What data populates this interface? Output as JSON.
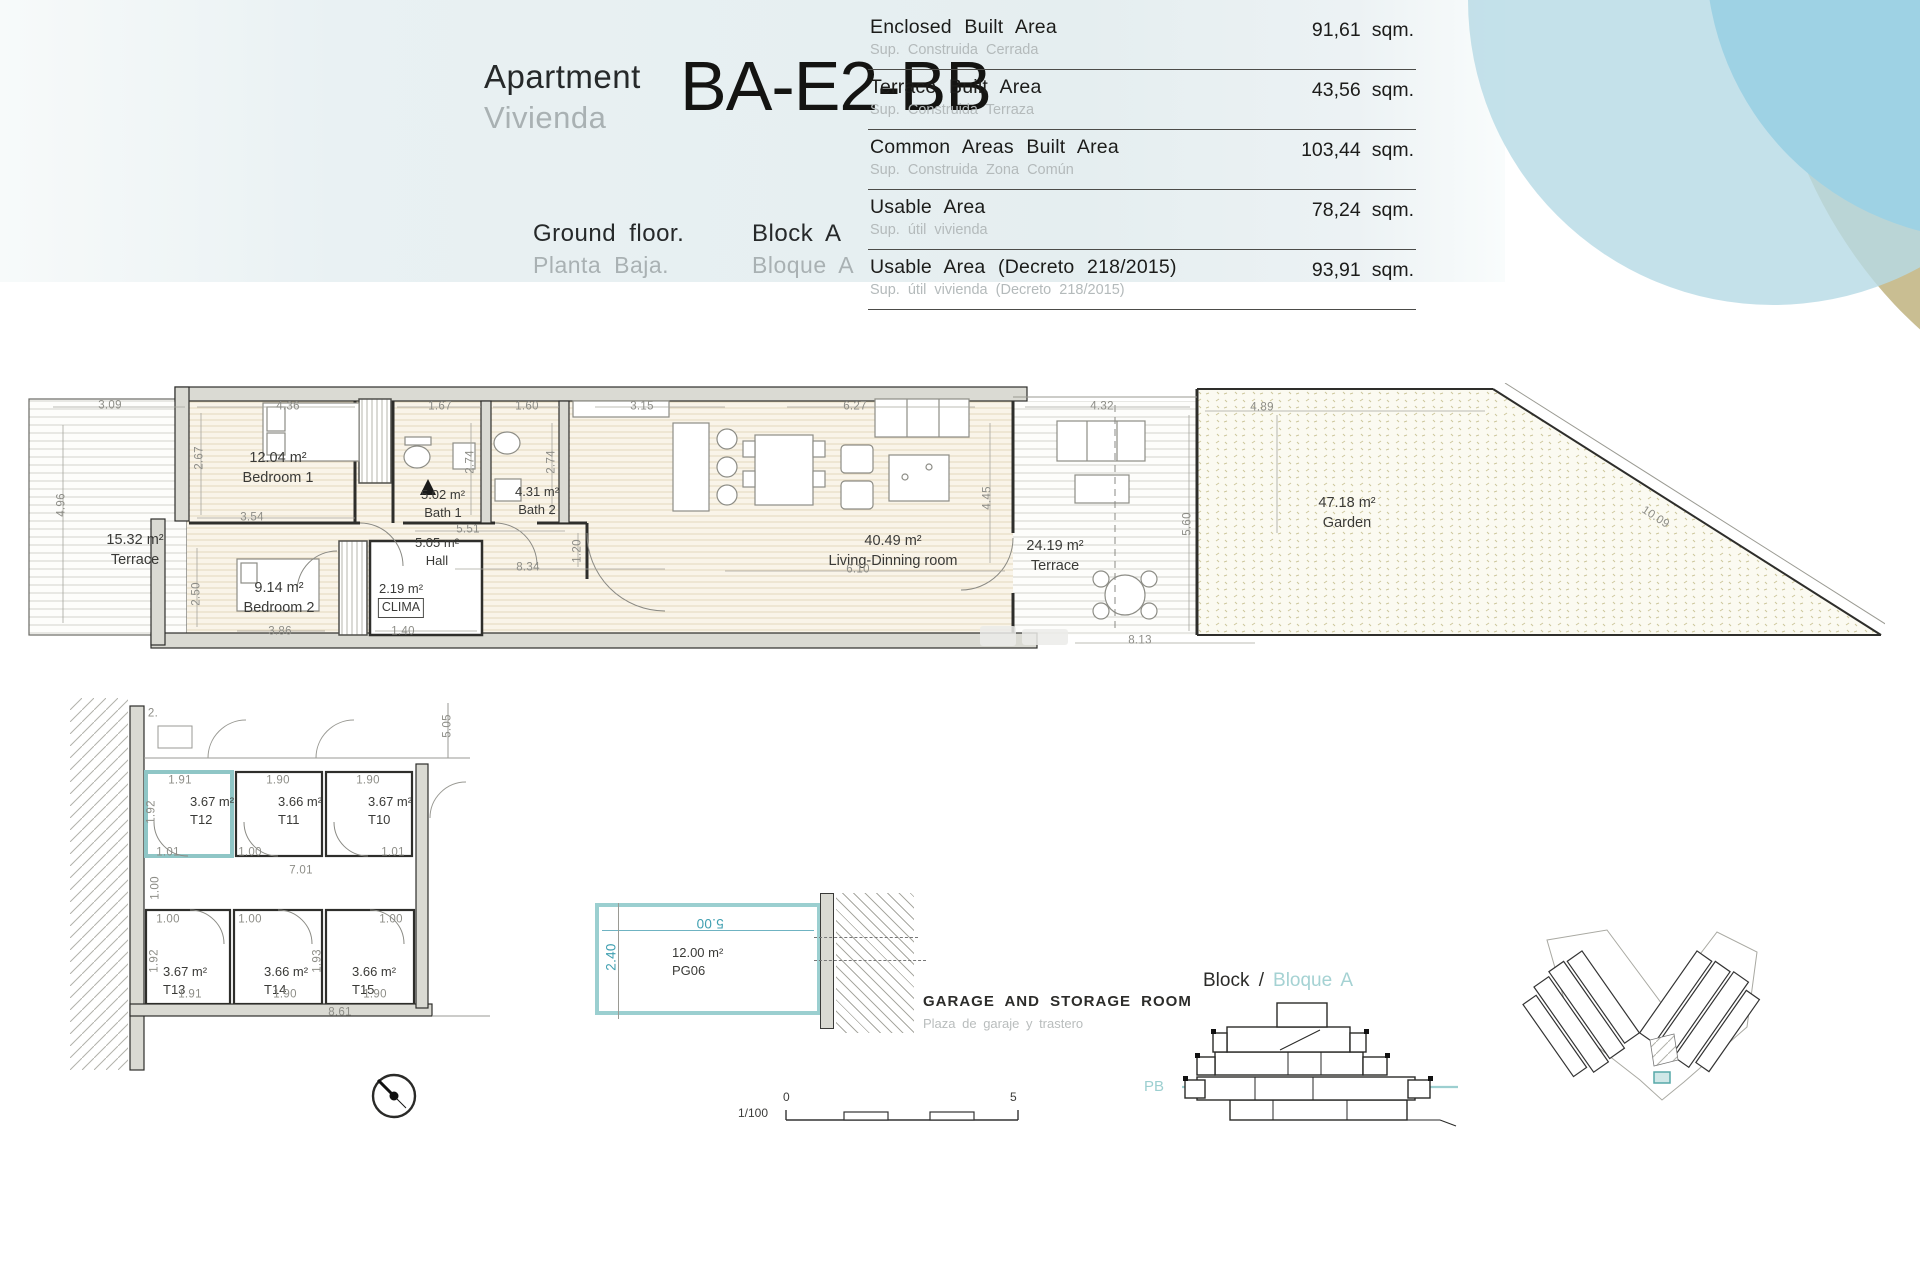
{
  "header": {
    "apartment_en": "Apartment",
    "apartment_es": "Vivienda",
    "unit_code": "BA-E2-BB",
    "floor_en": "Ground floor.",
    "floor_es": "Planta Baja.",
    "block_en": "Block A",
    "block_es": "Bloque A"
  },
  "areas_table": {
    "unit": "sqm.",
    "rows": [
      {
        "label_en": "Enclosed Built Area",
        "label_es": "Sup. Construida Cerrada",
        "value": "91,61"
      },
      {
        "label_en": "Terrace Built Area",
        "label_es": "Sup. Construida Terraza",
        "value": "43,56"
      },
      {
        "label_en": "Common Areas Built Area",
        "label_es": "Sup. Construida Zona Común",
        "value": "103,44"
      },
      {
        "label_en": "Usable Area",
        "label_es": "Sup. útil vivienda",
        "value": "78,24"
      },
      {
        "label_en": "Usable Area (Decreto 218/2015)",
        "label_es": "Sup. útil vivienda (Decreto 218/2015)",
        "value": "93,91"
      }
    ]
  },
  "floor_plan": {
    "rooms": [
      {
        "area": "15.32 m²",
        "name": "Terrace"
      },
      {
        "area": "12.04 m²",
        "name": "Bedroom 1"
      },
      {
        "area": "5.02 m²",
        "name": "Bath 1"
      },
      {
        "area": "4.31 m²",
        "name": "Bath 2"
      },
      {
        "area": "5.05 m²",
        "name": "Hall"
      },
      {
        "area": "9.14 m²",
        "name": "Bedroom 2"
      },
      {
        "area": "2.19 m²",
        "name": "CLIMA"
      },
      {
        "area": "40.49 m²",
        "name": "Living-Dinning room"
      },
      {
        "area": "24.19 m²",
        "name": "Terrace"
      },
      {
        "area": "47.18 m²",
        "name": "Garden"
      }
    ],
    "dims": {
      "terrace_w": "3.09",
      "terrace_h": "4.96",
      "bed1_w": "4.36",
      "bed1_h": "2.67",
      "bed1_b": "3.54",
      "bath1_w": "1.67",
      "bath1_h": "2.74",
      "bath2_w": "1.60",
      "bath2_h": "2.74",
      "kitchen_w": "3.15",
      "living_w": "6.27",
      "living_h": "4.45",
      "living_b": "6.10",
      "hall_w": "5.51",
      "hall_b": "8.34",
      "hall_h": "1.20",
      "bed2_b": "3.86",
      "bed2_h": "2.50",
      "clima_w": "1.40",
      "terrace2_w": "4.32",
      "terrace2_h": "5.60",
      "garden_w": "4.89",
      "garden_diag": "10.09",
      "garden_b": "8.13"
    }
  },
  "storage_plan": {
    "rooms": [
      {
        "area": "3.67 m²",
        "name": "T12"
      },
      {
        "area": "3.66 m²",
        "name": "T11"
      },
      {
        "area": "3.67 m²",
        "name": "T10"
      },
      {
        "area": "3.67 m²",
        "name": "T13"
      },
      {
        "area": "3.66 m²",
        "name": "T14"
      },
      {
        "area": "3.66 m²",
        "name": "T15"
      }
    ],
    "dims": {
      "t12_w": "1.91",
      "t11_w": "1.90",
      "t10_w": "1.90",
      "row1_h": "1.92",
      "t12_d": "1.01",
      "t11_d": "1.00",
      "t10_d": "1.01",
      "corridor_w": "7.01",
      "corridor_h": "1.00",
      "t13_d": "1.00",
      "t14_d": "1.00",
      "t15_d": "1.00",
      "t13_w": "1.91",
      "t14_w": "1.90",
      "t15_w": "1.90",
      "row2_h": "1.92",
      "row2_h2": "1.93",
      "total_w": "8.61",
      "right_h": "5.05",
      "cut": "2."
    }
  },
  "garage": {
    "area": "12.00 m²",
    "code": "PG06",
    "dim_w": "5.00",
    "dim_h": "2.40",
    "title_en": "GARAGE AND STORAGE ROOM",
    "title_es": "Plaza de garaje y trastero"
  },
  "section": {
    "title_en": "Block /",
    "title_es": "Bloque A",
    "level": "PB"
  },
  "scale_bar": {
    "ratio": "1/100",
    "start": "0",
    "end": "5"
  },
  "colors": {
    "accent_teal": "#8fc6c6",
    "accent_blue": "#2fa9dc",
    "pale_blue": "#b7dae5",
    "tan": "#c9be92",
    "wall_fill": "#dadad3",
    "wood_line": "#e3d6bd",
    "garden_mark": "#cdc79c"
  }
}
